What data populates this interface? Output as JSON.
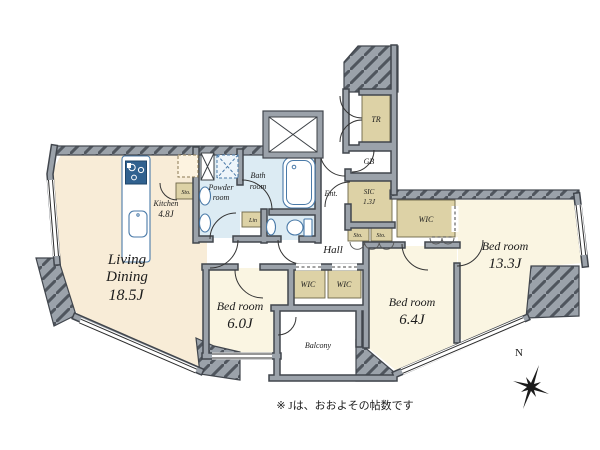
{
  "plan": {
    "note": "※ Jは、おおよその帖数です",
    "compass_north": "N",
    "rooms": {
      "living_dining": {
        "line1": "Living",
        "line2": "Dining",
        "size": "18.5J"
      },
      "kitchen": {
        "label": "Kitchen",
        "size": "4.8J"
      },
      "bedroom_small": {
        "label": "Bed room",
        "size": "6.0J"
      },
      "bedroom_mid": {
        "label": "Bed room",
        "size": "6.4J"
      },
      "bedroom_large": {
        "label": "Bed room",
        "size": "13.3J"
      },
      "bath": {
        "line1": "Bath",
        "line2": "room"
      },
      "powder": {
        "line1": "Powder",
        "line2": "room"
      },
      "hall": {
        "label": "Hall"
      },
      "entrance": {
        "label": "Ent."
      },
      "balcony": {
        "label": "Balcony"
      },
      "sic": {
        "label": "SIC",
        "size": "1.3J"
      },
      "trunk_room": {
        "label": "TR"
      },
      "garbage_box": {
        "label": "GB"
      },
      "linen": {
        "label": "Lin"
      },
      "wic_a": {
        "label": "WIC"
      },
      "wic_b": {
        "label": "WIC"
      },
      "wic_c": {
        "label": "WIC"
      },
      "sto_kitchen": {
        "label": "Sto."
      },
      "sto_a": {
        "label": "Sto."
      },
      "sto_b": {
        "label": "Sto."
      }
    },
    "colors": {
      "room_warm": "#f8ecd7",
      "room_pale": "#faf5e2",
      "wet": "#dcebf3",
      "closet": "#ddd2a6",
      "closet_edge": "#6d6548",
      "wall": "#9ba2aa",
      "wall_edge": "#41464d",
      "fixture": "#4a7aa8"
    }
  }
}
